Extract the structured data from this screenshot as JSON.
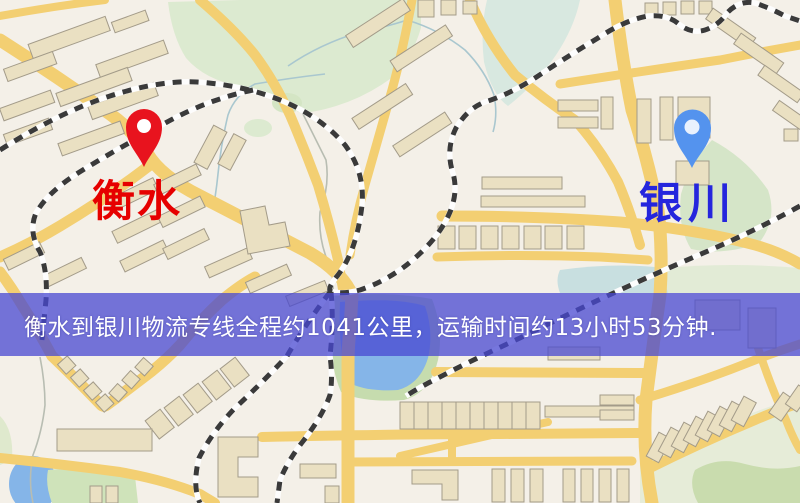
{
  "banner": {
    "text": "衡水到银川物流专线全程约1041公里，运输时间约13小时53分钟.",
    "background_color": "rgba(72,72,210,0.75)",
    "text_color": "#ffffff",
    "top_px": 293,
    "height_px": 63
  },
  "route": {
    "origin_city": "衡水",
    "destination_city": "银川",
    "distance_km": "1041",
    "duration": "13小时53分钟"
  },
  "markers": [
    {
      "name": "origin-pin",
      "city": "衡水",
      "pin_color": "#e8131e",
      "label_color": "#e60000"
    },
    {
      "name": "destination-pin",
      "city": "银川",
      "pin_color": "#5493ee",
      "label_color": "#2526dd"
    }
  ],
  "map_colors": {
    "background": "#f4f0e8",
    "road": "#f3cf72",
    "park_green": "#dcead0",
    "water_blue": "#85b5e8",
    "building_tan": "#eae0c2",
    "railway_dark": "#3a3a3a"
  }
}
